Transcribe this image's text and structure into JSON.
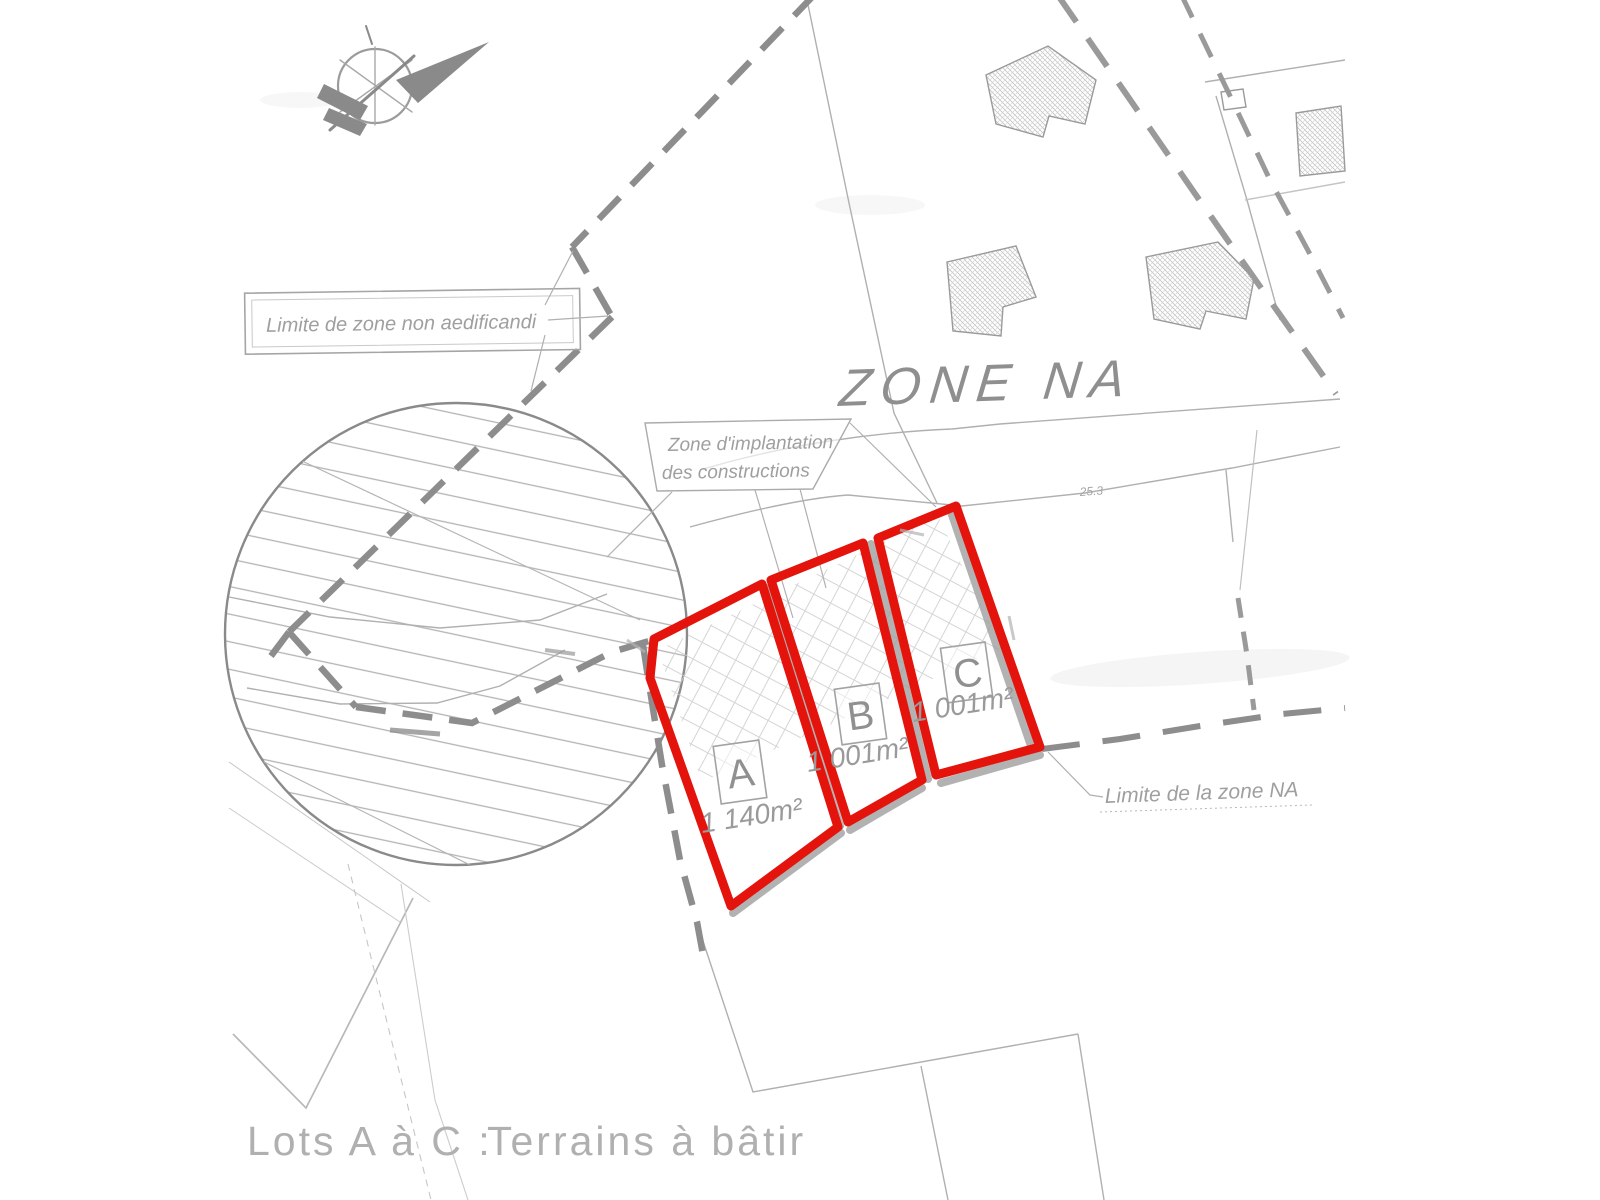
{
  "map": {
    "zone_label": "ZONE NA",
    "annotations": {
      "non_aedificandi": "Limite de zone non aedificandi",
      "implantation_l1": "Zone d'implantation",
      "implantation_l2": "des constructions",
      "zone_na_limit": "Limite de la zone NA",
      "dimension": "25.3"
    },
    "lots": [
      {
        "id": "A",
        "area": "1 140m²"
      },
      {
        "id": "B",
        "area": "1 001m²"
      },
      {
        "id": "C",
        "area": "1 001m²"
      }
    ],
    "caption": {
      "prefix": "Lots A à C :",
      "text": "Terrains à bâtir"
    },
    "colors": {
      "lot_outline": "#e4130c",
      "drawing_gray": "#9a9a9a",
      "label_gray": "#9f9f9f",
      "caption_gray": "#b0b0b0"
    }
  }
}
